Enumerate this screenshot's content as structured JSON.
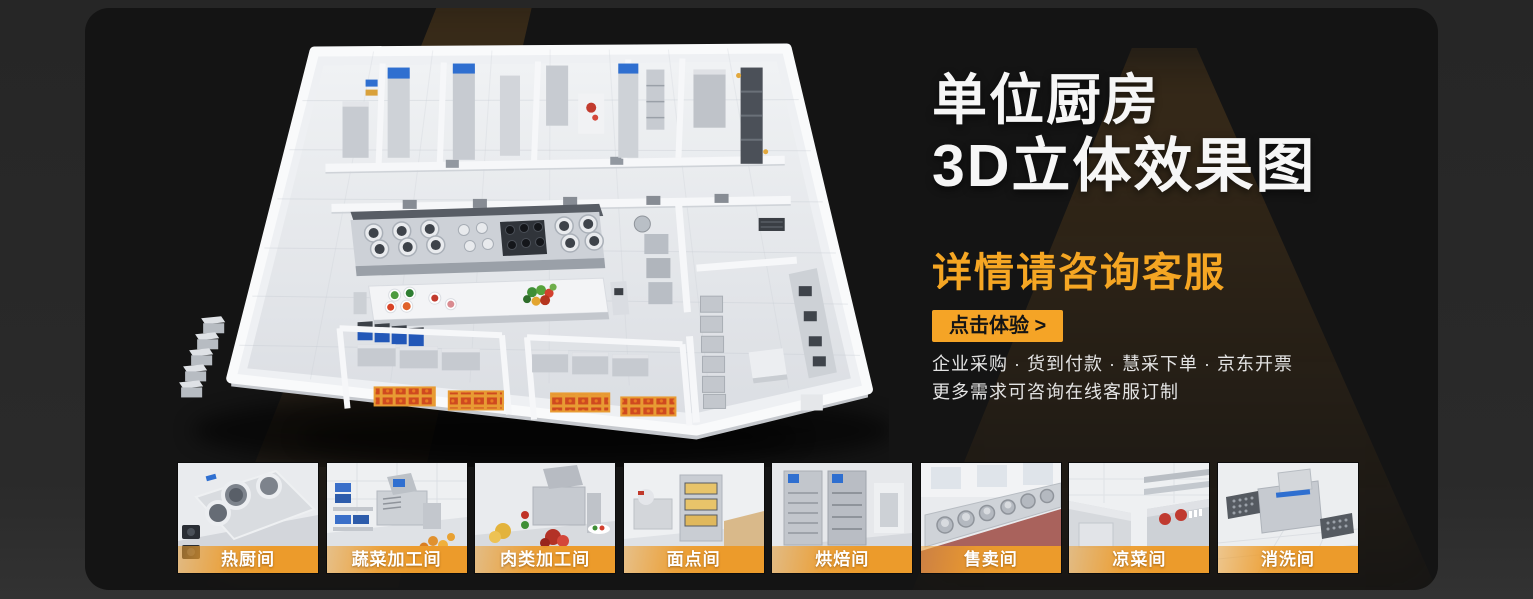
{
  "colors": {
    "accent_orange": "#F5A623",
    "cta_background": "#F5A426",
    "label_bar_orange": "#EC9B2B",
    "panel_background": "#141414",
    "outer_background": "#2A2A2A"
  },
  "hero": {
    "title_line1": "单位厨房",
    "title_line2": "3D立体效果图",
    "subtitle": "详情请咨询客服",
    "cta_label": "点击体验 >",
    "bullet_line1": "企业采购 · 货到付款 · 慧采下单 · 京东开票",
    "bullet_line2": "更多需求可咨询在线客服订制"
  },
  "floorplan": {
    "type": "3d-isometric-kitchen-render"
  },
  "thumbnails": [
    {
      "label": "热厨间"
    },
    {
      "label": "蔬菜加工间"
    },
    {
      "label": "肉类加工间"
    },
    {
      "label": "面点间"
    },
    {
      "label": "烘焙间"
    },
    {
      "label": "售卖间"
    },
    {
      "label": "凉菜间"
    },
    {
      "label": "消洗间"
    }
  ]
}
